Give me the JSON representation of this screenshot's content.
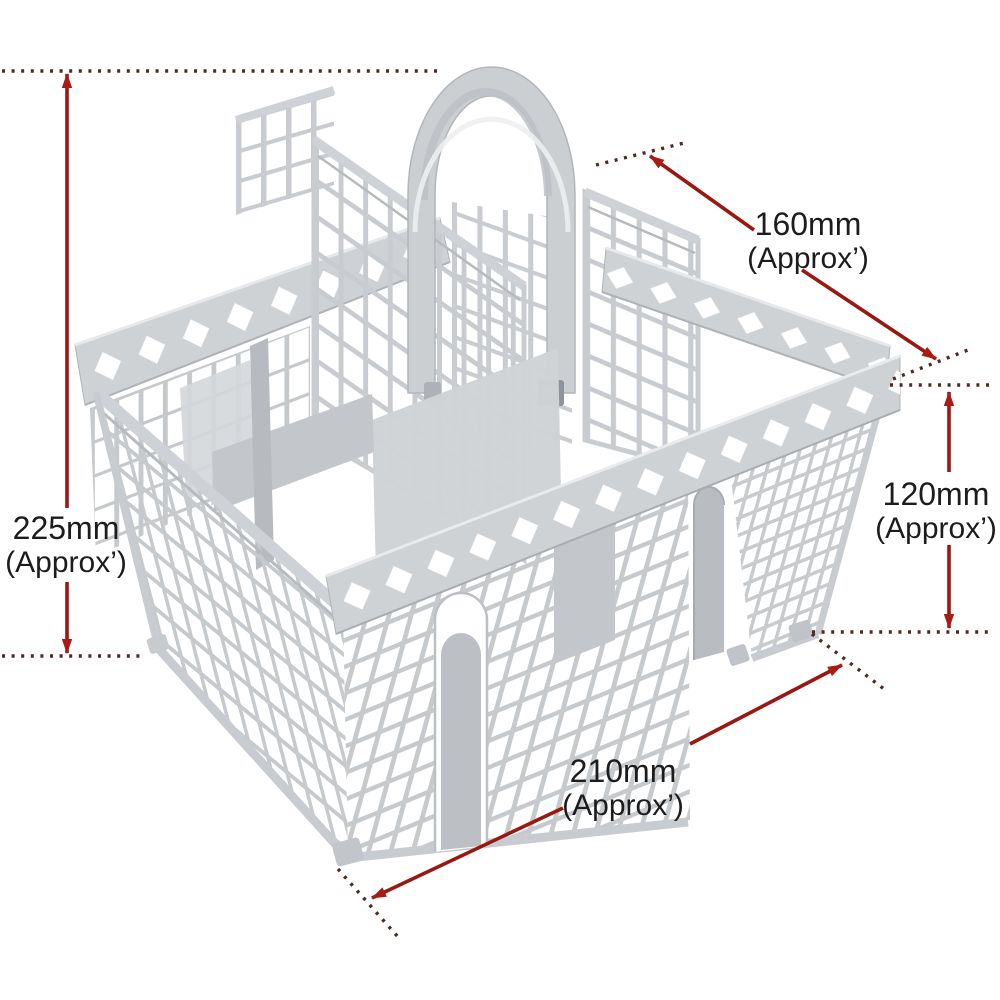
{
  "figure": {
    "subject": "gray plastic dishwasher cutlery basket with carry handle",
    "view": "isometric product photo with dimension callouts"
  },
  "dimensions": {
    "height_left": {
      "value": "225mm",
      "qualifier": "(Approx’)"
    },
    "depth_top_right": {
      "value": "160mm",
      "qualifier": "(Approx’)"
    },
    "side_height_right": {
      "value": "120mm",
      "qualifier": "(Approx’)"
    },
    "width_bottom": {
      "value": "210mm",
      "qualifier": "(Approx’)"
    }
  },
  "colors": {
    "background": "#ffffff",
    "label_text": "#1c1c1c",
    "dimension_line": "#991812",
    "dimension_arrow": "#a81c14",
    "dimension_dots": "#4e2a24",
    "basket_plastic": "#c7cbce",
    "basket_rail": "#ced2d6",
    "basket_shadow": "#9ea2a7"
  }
}
